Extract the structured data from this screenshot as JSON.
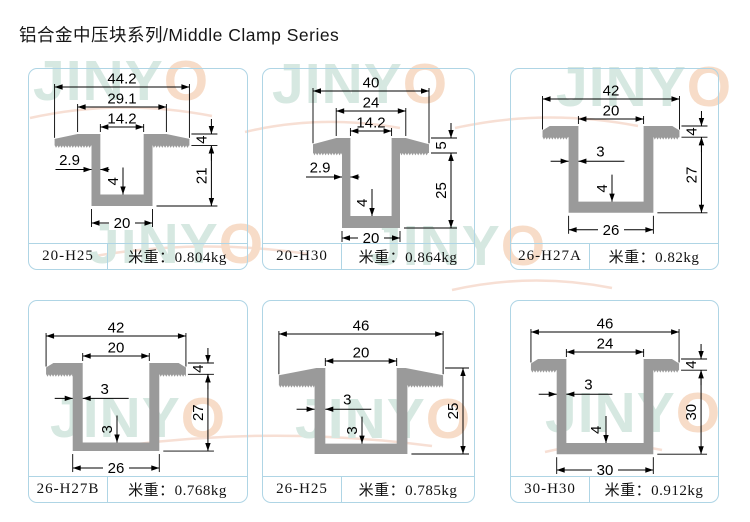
{
  "page": {
    "title": "铝合金中压块系列/Middle Clamp Series"
  },
  "branding": {
    "watermark_text": "JINYO",
    "watermark_letters": "JINY",
    "watermark_o": "O",
    "watermark_letter_color": "#d6e8e1",
    "watermark_o_color": "#f7dcc8",
    "watermark_arc_color": "#f6dccf"
  },
  "style": {
    "card_border": "#afd5e5",
    "profile_fill": "#9a9a9a",
    "dimension_color": "#000000"
  },
  "cards": [
    {
      "model": "20-H25",
      "weight": "米重：0.804kg",
      "profile_mm": {
        "shape": "tapered",
        "top_width": 44.2,
        "flat_top_width": 29.1,
        "opening_width": 14.2,
        "wall_thickness": 2.9,
        "channel_outer_width": 20,
        "overall_height": 25,
        "flange_thickness": 4,
        "bottom_thickness": 4
      },
      "dims": {
        "top": [
          {
            "label": "44.2",
            "ref": "W"
          },
          {
            "label": "29.1",
            "ref": "FT"
          },
          {
            "label": "14.2",
            "ref": "O"
          }
        ],
        "wall": {
          "label": "2.9",
          "side": "left"
        },
        "inner": "4",
        "flange": "4",
        "height": {
          "label": "21",
          "from": "flange"
        },
        "bottom": "20"
      }
    },
    {
      "model": "20-H30",
      "weight": "米重：0.864kg",
      "profile_mm": {
        "shape": "tapered",
        "top_width": 40,
        "flat_top_width": 24,
        "opening_width": 14.2,
        "wall_thickness": 2.9,
        "channel_outer_width": 20,
        "overall_height": 30,
        "flange_thickness": 5,
        "bottom_thickness": 4
      },
      "dims": {
        "top": [
          {
            "label": "40",
            "ref": "W"
          },
          {
            "label": "24",
            "ref": "FT"
          },
          {
            "label": "14.2",
            "ref": "O"
          }
        ],
        "wall": {
          "label": "2.9",
          "side": "left"
        },
        "inner": "4",
        "flange": "5",
        "height": {
          "label": "25",
          "from": "flange"
        },
        "bottom": "20"
      }
    },
    {
      "model": "26-H27A",
      "weight": "米重：0.82kg",
      "profile_mm": {
        "shape": "flat",
        "top_width": 42,
        "flat_top_width": 42,
        "opening_width": 20,
        "wall_thickness": 3,
        "channel_outer_width": 26,
        "overall_height": 31,
        "flange_thickness": 4,
        "bottom_thickness": 4
      },
      "dims": {
        "top": [
          {
            "label": "42",
            "ref": "W"
          },
          {
            "label": "20",
            "ref": "O"
          }
        ],
        "wall": {
          "label": "3",
          "side": "right"
        },
        "inner": "4",
        "flange": "4",
        "height": {
          "label": "27",
          "from": "flange"
        },
        "bottom": "26"
      }
    },
    {
      "model": "26-H27B",
      "weight": "米重：0.768kg",
      "profile_mm": {
        "shape": "flat",
        "top_width": 42,
        "flat_top_width": 42,
        "opening_width": 20,
        "wall_thickness": 3,
        "channel_outer_width": 26,
        "overall_height": 31,
        "flange_thickness": 4,
        "bottom_thickness": 3
      },
      "dims": {
        "top": [
          {
            "label": "42",
            "ref": "W"
          },
          {
            "label": "20",
            "ref": "O"
          }
        ],
        "wall": {
          "label": "3",
          "side": "right"
        },
        "inner": "3",
        "flange": "4",
        "height": {
          "label": "27",
          "from": "flange"
        },
        "bottom": "26"
      }
    },
    {
      "model": "26-H25",
      "weight": "米重：0.785kg",
      "profile_mm": {
        "shape": "tapered",
        "top_width": 46,
        "flat_top_width": 25,
        "opening_width": 20,
        "wall_thickness": 3,
        "channel_outer_width": 26,
        "overall_height": 25,
        "flange_thickness": 5,
        "bottom_thickness": 3
      },
      "dims": {
        "top": [
          {
            "label": "46",
            "ref": "W"
          },
          {
            "label": "20",
            "ref": "O"
          }
        ],
        "wall": {
          "label": "3",
          "side": "right"
        },
        "inner": "3",
        "flange": null,
        "height": {
          "label": "25",
          "from": "top"
        },
        "bottom": null
      }
    },
    {
      "model": "30-H30",
      "weight": "米重：0.912kg",
      "profile_mm": {
        "shape": "flat",
        "top_width": 46,
        "flat_top_width": 46,
        "opening_width": 24,
        "wall_thickness": 3,
        "channel_outer_width": 30,
        "overall_height": 34,
        "flange_thickness": 4,
        "bottom_thickness": 4
      },
      "dims": {
        "top": [
          {
            "label": "46",
            "ref": "W"
          },
          {
            "label": "24",
            "ref": "O"
          }
        ],
        "wall": {
          "label": "3",
          "side": "right"
        },
        "inner": "4",
        "flange": "4",
        "height": {
          "label": "30",
          "from": "flange"
        },
        "bottom": "30"
      }
    }
  ]
}
